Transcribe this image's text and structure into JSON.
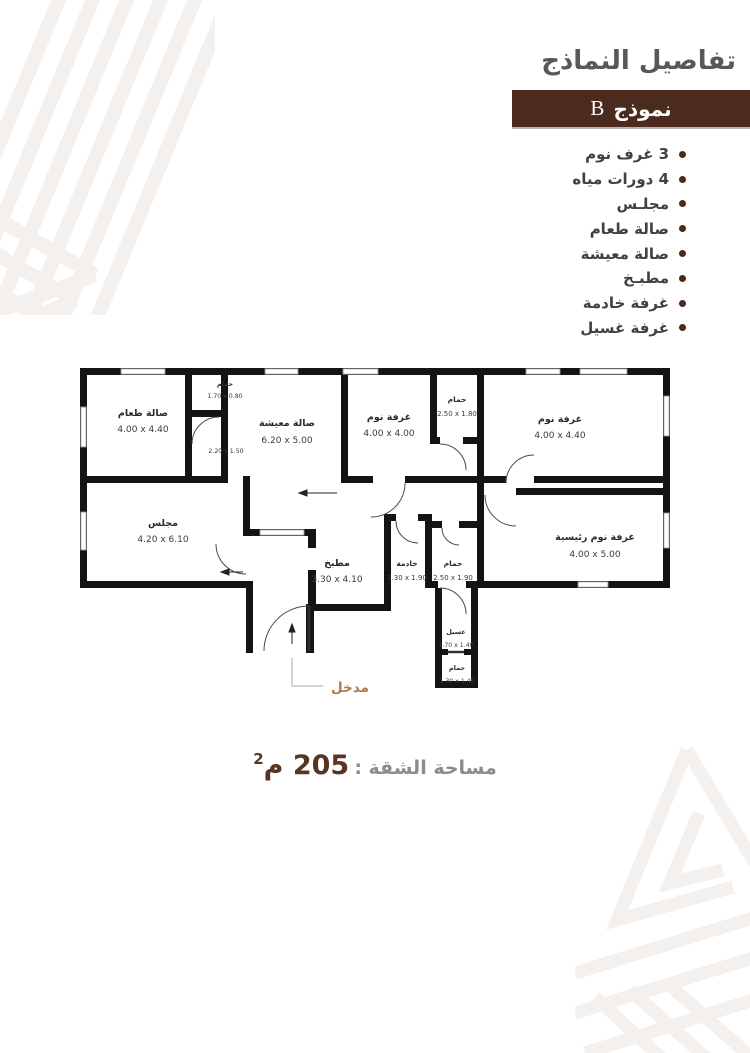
{
  "header": {
    "title": "تفاصيل النماذج",
    "model_label": "نموذج",
    "model_letter": "B"
  },
  "features": {
    "items": [
      {
        "label": "3 غرف نوم"
      },
      {
        "label": "4 دورات مياه"
      },
      {
        "label": "مجلـس"
      },
      {
        "label": "صالة طعام"
      },
      {
        "label": "صالة معيشة"
      },
      {
        "label": "مطبـخ"
      },
      {
        "label": "غرفة خادمة"
      },
      {
        "label": "غرفة غسيل"
      }
    ]
  },
  "plan": {
    "entrance_label": "مدخل",
    "rooms": {
      "dining": {
        "name": "صالة طعام",
        "dims": "4.00 x 4.40"
      },
      "bath1": {
        "name": "حمام",
        "dims": "1.70 x 0.80"
      },
      "closet": {
        "dims": "2.20 x 1.50"
      },
      "living": {
        "name": "صالة معيشة",
        "dims": "6.20 x 5.00"
      },
      "bedroom1": {
        "name": "غرفة نوم",
        "dims": "4.00 x 4.00"
      },
      "bath2": {
        "name": "حمام",
        "dims": "2.50 x 1.80"
      },
      "bedroom2": {
        "name": "غرفة نوم",
        "dims": "4.00 x 4.40"
      },
      "majlis": {
        "name": "مجلس",
        "dims": "4.20 x 6.10"
      },
      "kitchen": {
        "name": "مطبخ",
        "dims": "3.30 x 4.10"
      },
      "maid": {
        "name": "خادمة",
        "dims": "3.30 x 1.90"
      },
      "bath3": {
        "name": "حمام",
        "dims": "2.50 x 1.90"
      },
      "master": {
        "name": "غرفة نوم رئيسية",
        "dims": "4.00 x 5.00"
      },
      "laundry": {
        "name": "غسيل",
        "dims": "1.70 x 1.40"
      },
      "bath4": {
        "name": "حمام",
        "dims": "1.30 x 1.40"
      }
    }
  },
  "footer": {
    "area_label": "مساحة الشقة :",
    "area_value": "205",
    "area_unit": "م",
    "area_superscript": "2"
  },
  "colors": {
    "bar_brown": "#4b2b1d",
    "bullet_brown": "#4a281a",
    "title_gray": "#58585a",
    "list_text_gray": "#414042",
    "entrance_brown": "#a87a4e",
    "area_value_brown": "#5a3423",
    "wall_black": "#141414",
    "pattern_beige": "#f3f0ed"
  }
}
